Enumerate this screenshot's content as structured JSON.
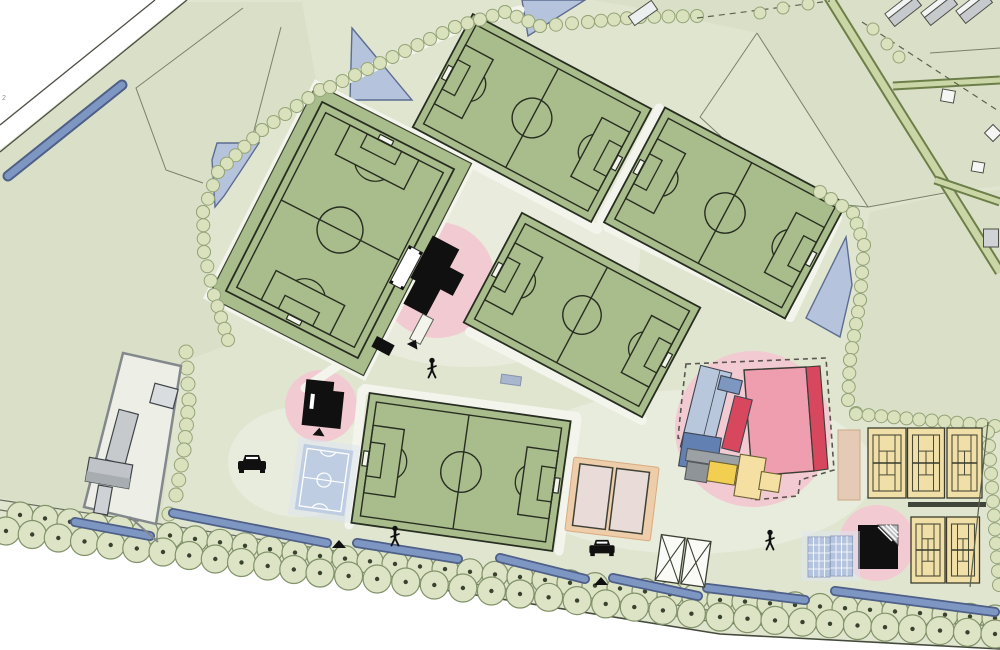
{
  "app": {
    "title": "Sports park site plan"
  },
  "labels": {
    "road_marker": "2"
  },
  "palette": {
    "outside_white": "#ffffff",
    "site_green": "#e0e5d0",
    "parcel_tint": "#d8dfc5",
    "plaza_light": "#f2f4ea",
    "pitch_green": "#a9bc8b",
    "pitch_line": "#272d20",
    "path_white": "#f3f5ec",
    "water_fill": "#b5c3dc",
    "water_edge": "#5d6d91",
    "ditch_blue": "#7e96c2",
    "ditch_edge": "#4e5f88",
    "pink_zone": "#f2cad2",
    "tree_fill": "#d9e1bd",
    "tree_edge": "#95a478",
    "big_tree_fill": "#dde4c6",
    "big_tree_edge": "#82926a",
    "big_tree_dot": "#39412f",
    "lane_fill": "#cbd6a6",
    "lane_edge": "#6d7f49",
    "building_black": "#101010",
    "hall_pink": "#ee9eae",
    "accent_red": "#d7485f",
    "block_blue_light": "#b8c7dc",
    "block_blue": "#6280b2",
    "block_blue_mid": "#7d97c1",
    "block_yellow": "#f2cf50",
    "block_yellow_pale": "#f5dfa2",
    "block_gray": "#9ba1a5",
    "tennis_tan": "#f1dfa8",
    "beige_court": "#e9dcd8",
    "beige_border": "#edcdaa",
    "futsal_blue": "#bccbe3",
    "gray_building": "#c6cacd",
    "parcel_line": "#79816b",
    "road_line": "#696f60",
    "boundary_dark": "#454b3c"
  },
  "icons": [
    {
      "name": "car-icon",
      "meaning": "parked car / parking area"
    },
    {
      "name": "pedestrian-icon",
      "meaning": "person walking"
    },
    {
      "name": "entrance-marker-icon",
      "meaning": "site entrance triangle"
    }
  ],
  "features": {
    "football_pitches": 5,
    "tennis_courts": 5,
    "padel_mini_courts": 2,
    "futsal_court": 1,
    "beach_courts": 2,
    "bike_rack_frames": 2,
    "clubhouse_buildings": 3,
    "sports_hall_complex_blocks": 10,
    "highlight_zones_pink": 4,
    "ponds": 4,
    "drainage_ditches": 8,
    "farm_buildings": 4,
    "cars": 2,
    "pedestrians": 3
  }
}
